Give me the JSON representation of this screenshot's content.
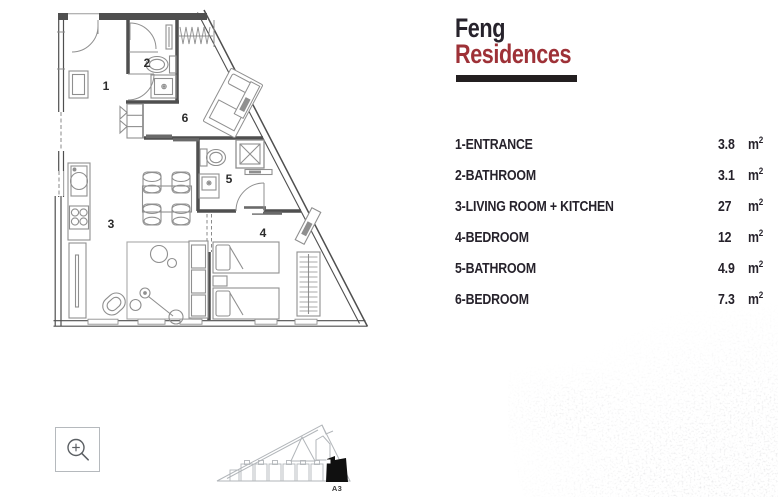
{
  "brand": {
    "title_line1": "Feng",
    "title_line2": "Residences"
  },
  "legend": {
    "unit_base": "m",
    "unit_sup": "2",
    "rows": [
      {
        "name": "1-ENTRANCE",
        "value": "3.8"
      },
      {
        "name": "2-BATHROOM",
        "value": "3.1"
      },
      {
        "name": "3-LIVING ROOM + KITCHEN",
        "value": "27"
      },
      {
        "name": "4-BEDROOM",
        "value": "12"
      },
      {
        "name": "5-BATHROOM",
        "value": "4.9"
      },
      {
        "name": "6-BEDROOM",
        "value": "7.3"
      }
    ]
  },
  "floor_plan": {
    "room_numbers": [
      "1",
      "2",
      "3",
      "4",
      "5",
      "6"
    ]
  },
  "site_plan": {
    "highlighted_unit": "A3"
  },
  "icons": {
    "zoom_button": "magnifier-plus-icon"
  },
  "colors": {
    "title_text": "#26222b",
    "accent_red": "#9e3137",
    "divider_bar": "#231f20",
    "plan_walls": "#4f4f4f",
    "plan_furniture": "#8f8f8f",
    "siteplan_outline": "#b2b6ba",
    "siteplan_highlight": "#101010"
  }
}
